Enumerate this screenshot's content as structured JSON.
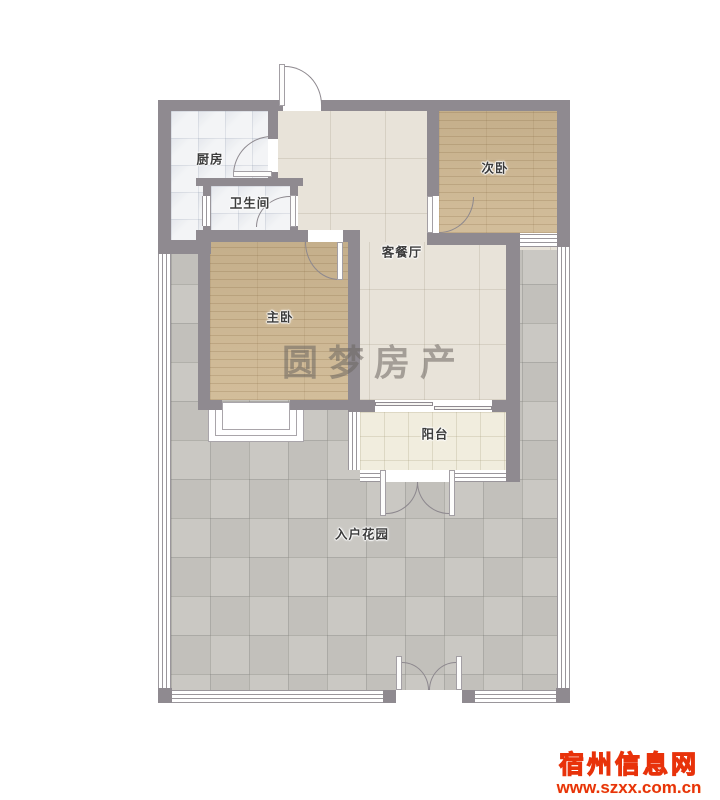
{
  "floor_plan": {
    "rooms": {
      "kitchen": "厨房",
      "bathroom": "卫生间",
      "secondary_bedroom": "次卧",
      "living_dining_room": "客餐厅",
      "master_bedroom": "主卧",
      "balcony": "阳台",
      "entrance_garden": "入户花园"
    },
    "watermark_agency": "圆梦房产",
    "site_watermark": {
      "site_name": "宿州信息网",
      "site_url": "www.szxx.com.cn"
    },
    "colors": {
      "wall": "#8f8a90",
      "wood_floor": "#cfb892",
      "living_tile": "#e8e3d9",
      "kitchen_tile": "#f3f4f6",
      "balcony_tile": "#f1edde",
      "garden_tile": "#c7c5c0",
      "logo_yellow": "#ffd000",
      "logo_red": "#e8320a"
    }
  }
}
